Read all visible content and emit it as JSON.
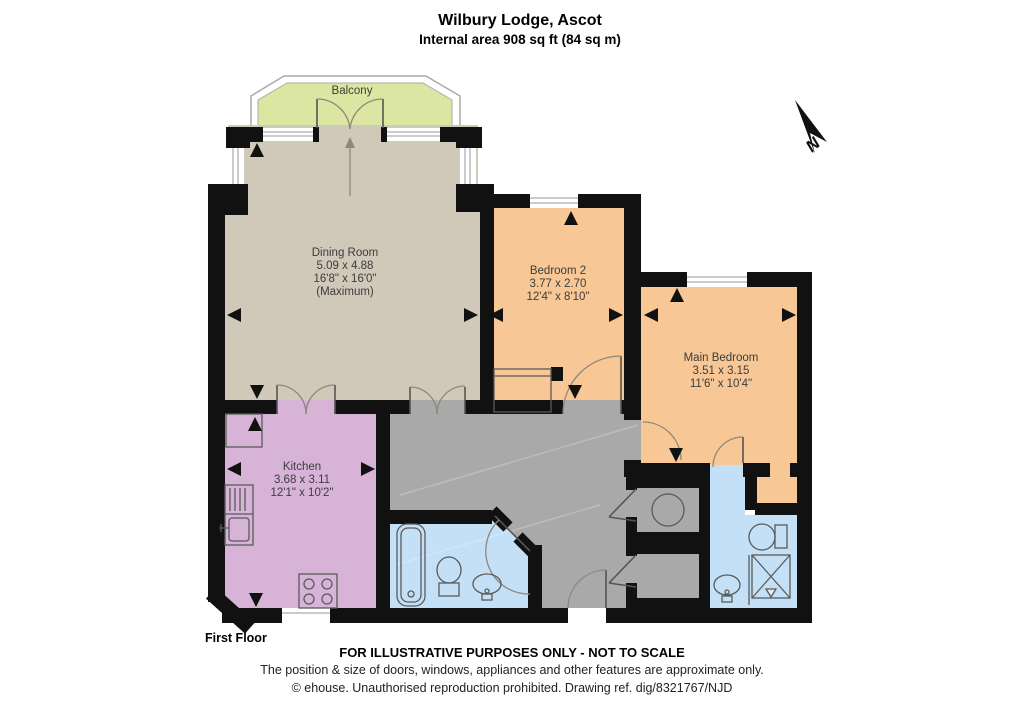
{
  "header": {
    "title": "Wilbury Lodge, Ascot",
    "subtitle": "Internal area 908 sq ft (84 sq m)"
  },
  "plan": {
    "floor_label": "First Floor",
    "compass_label": "N",
    "rooms": {
      "balcony": {
        "name": "Balcony"
      },
      "dining_room": {
        "name": "Dining Room",
        "size_metric": "5.09 x 4.88",
        "size_imperial": "16'8\" x 16'0\"",
        "size_note": "(Maximum)"
      },
      "bedroom_2": {
        "name": "Bedroom 2",
        "size_metric": "3.77 x 2.70",
        "size_imperial": "12'4\" x 8'10\""
      },
      "main_bedroom": {
        "name": "Main Bedroom",
        "size_metric": "3.51 x 3.15",
        "size_imperial": "11'6\" x 10'4\""
      },
      "kitchen": {
        "name": "Kitchen",
        "size_metric": "3.68 x 3.11",
        "size_imperial": "12'1\" x 10'2\""
      }
    }
  },
  "footer": {
    "disclaimer": "FOR ILLUSTRATIVE PURPOSES ONLY - NOT TO SCALE",
    "note": "The position & size of doors, windows, appliances and other features are approximate only.",
    "copyright": "© ehouse. Unauthorised reproduction prohibited. Drawing ref. dig/8321767/NJD"
  },
  "colors": {
    "wall": "#111111",
    "dining": "#d0c8b9",
    "bedroom": "#f7c795",
    "kitchen": "#d6b3d7",
    "hall": "#a9a9a9",
    "bathroom": "#c4e0f6",
    "balcony": "#dce6a3"
  }
}
